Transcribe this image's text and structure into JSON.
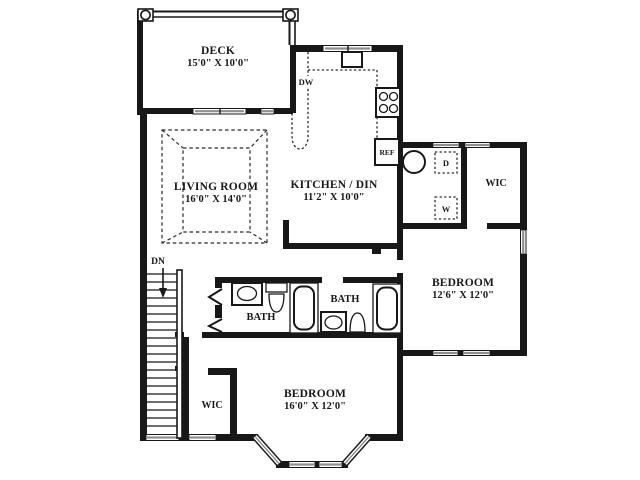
{
  "floor_plan": {
    "rooms": {
      "deck": {
        "name": "DECK",
        "dims": "15'0\" X 10'0\""
      },
      "living_room": {
        "name": "LIVING ROOM",
        "dims": "16'0\" X 14'0\""
      },
      "kitchen": {
        "name": "KITCHEN / DIN",
        "dims": "11'2\" X 10'0\""
      },
      "wic_upper": {
        "name": "WIC"
      },
      "bedroom_right": {
        "name": "BEDROOM",
        "dims": "12'6\" X 12'0\""
      },
      "bath_left": {
        "name": "BATH"
      },
      "bath_right": {
        "name": "BATH"
      },
      "wic_lower": {
        "name": "WIC"
      },
      "bedroom_lower": {
        "name": "BEDROOM",
        "dims": "16'0\" X 12'0\""
      }
    },
    "labels": {
      "stairs_down": "DN",
      "dishwasher": "DW",
      "refrigerator": "REF",
      "dryer": "D",
      "washer": "W"
    },
    "colors": {
      "wall": "#181818",
      "background": "#ffffff",
      "window_glass": "#8f8f8f"
    }
  }
}
